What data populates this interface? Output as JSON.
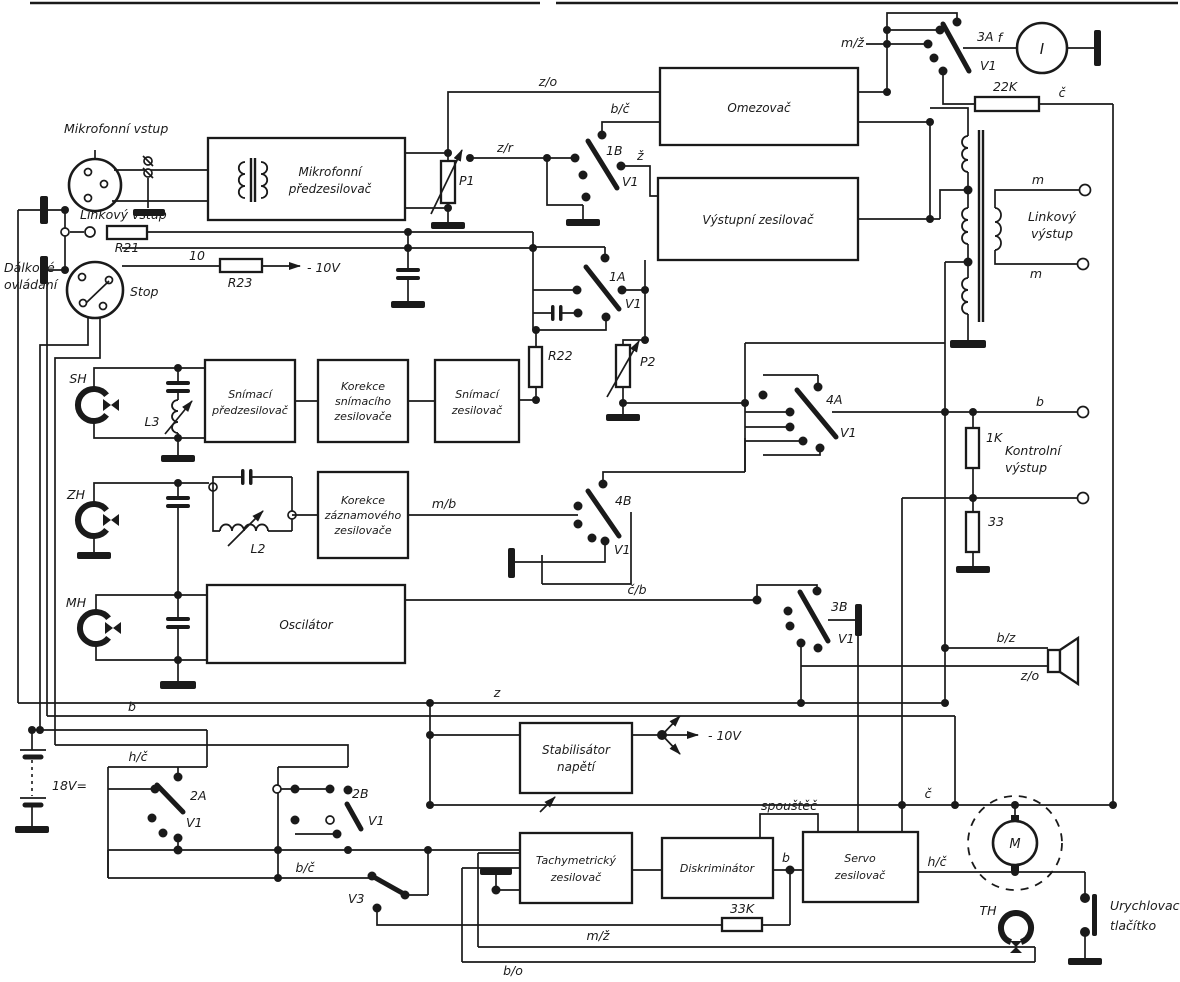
{
  "diagram": {
    "background": "#ffffff",
    "ink": "#1a1a1a"
  },
  "blocks": {
    "mic_preamp": {
      "lines": [
        "Mikrofonní",
        "předzesilovač"
      ]
    },
    "omezovac": {
      "lines": [
        "Omezovač"
      ]
    },
    "vystupni_zesilovac": {
      "lines": [
        "Výstupní  zesilovač"
      ]
    },
    "snimaci_predzesilovac": {
      "lines": [
        "Snímací",
        "předzesilovač"
      ]
    },
    "korekce_snimaciho": {
      "lines": [
        "Korekce",
        "snímacího",
        "zesilovače"
      ]
    },
    "snimaci_zesilovac": {
      "lines": [
        "Snímací",
        "zesilovač"
      ]
    },
    "korekce_zaznamoveho": {
      "lines": [
        "Korekce",
        "záznamového",
        "zesilovače"
      ]
    },
    "oscilator": {
      "lines": [
        "Oscilátor"
      ]
    },
    "stabilisator": {
      "lines": [
        "Stabilisátor",
        "napětí"
      ]
    },
    "tachymetricky": {
      "lines": [
        "Tachymetrický",
        "zesilovač"
      ]
    },
    "diskriminator": {
      "lines": [
        "Diskriminátor"
      ]
    },
    "servo": {
      "lines": [
        "Servo",
        "zesilovač"
      ]
    }
  },
  "ports": {
    "mic_input": "Mikrofonní vstup",
    "line_input": "Linkový vstup",
    "remote_line1": "Dálkové",
    "remote_line2": "ovládání",
    "stop": "Stop",
    "line_output_line1": "Linkový",
    "line_output_line2": "výstup",
    "control_output_line1": "Kontrolní",
    "control_output_line2": "výstup",
    "accel_line1": "Urychlovací",
    "accel_line2": "tlačítko"
  },
  "components": {
    "p1": "P1",
    "p2": "P2",
    "r21": "R21",
    "r22": "R22",
    "r23": "R23",
    "r23_mult": "10",
    "r_22k": "22K",
    "r_1k": "1K",
    "r_33": "33",
    "r_33k": "33K",
    "l2": "L2",
    "l3": "L3",
    "battery": "18V=",
    "motor": "M",
    "meter": "I",
    "minus10_top": "- 10V",
    "minus10_stab": "- 10V"
  },
  "heads": {
    "sh": "SH",
    "zh": "ZH",
    "mh": "MH",
    "th": "TH"
  },
  "switches": {
    "s1a": {
      "id": "1A",
      "tube": "V1"
    },
    "s1b": {
      "id": "1B",
      "tube": "V1"
    },
    "s2a": {
      "id": "2A",
      "tube": "V1"
    },
    "s2b": {
      "id": "2B",
      "tube": "V1"
    },
    "s3a": {
      "id": "3A",
      "tube": "V1"
    },
    "s3b": {
      "id": "3B",
      "tube": "V1"
    },
    "s4a": {
      "id": "4A",
      "tube": "V1"
    },
    "s4b": {
      "id": "4B",
      "tube": "V1"
    },
    "v3": {
      "id": "V3"
    }
  },
  "wire_labels": {
    "zo_top": "z/o",
    "bc_top": "b/č",
    "zr": "z/r",
    "z_record": "ž",
    "mz_top": "m/ž",
    "f_meter": "f",
    "c_right": "č",
    "m_out_top": "m",
    "m_out_bottom": "m",
    "b_control": "b",
    "mb": "m/b",
    "cb": "č/b",
    "bz": "b/z",
    "zo_speaker": "z/o",
    "z_rail": "z",
    "b_rail": "b",
    "hc_rail": "h/č",
    "spoustec": "spouštěč",
    "b_servo": "b",
    "mz_bottom": "m/ž",
    "bo": "b/o",
    "bc_v3": "b/č",
    "c_motor": "č",
    "hc_motor": "h/č"
  }
}
